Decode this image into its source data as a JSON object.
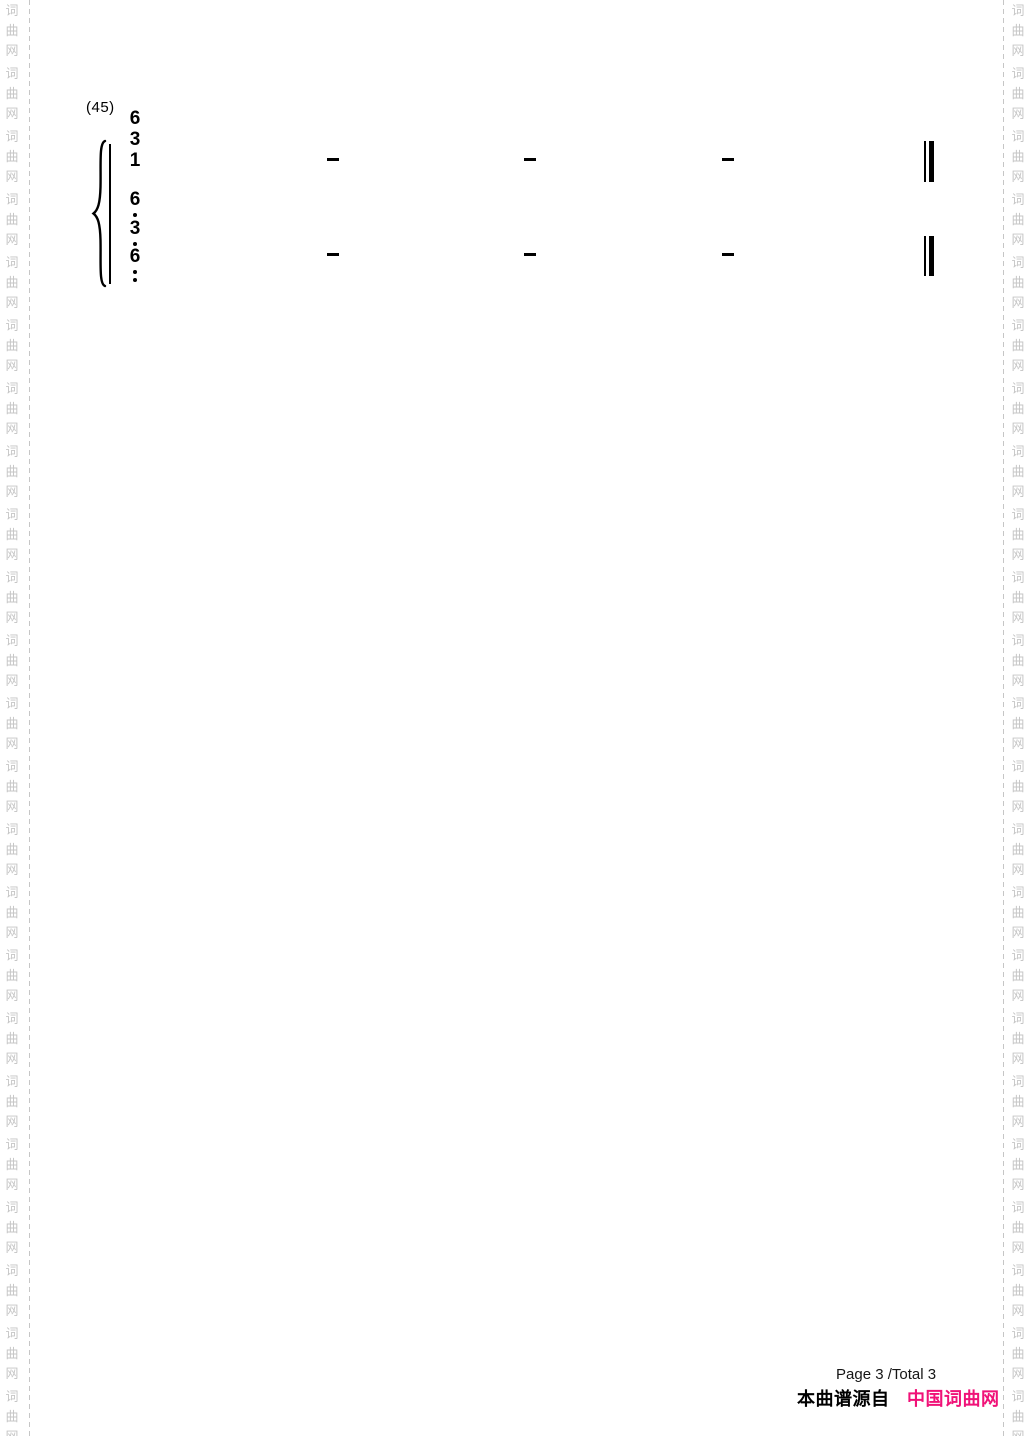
{
  "watermark": {
    "chars": [
      "词",
      "曲",
      "网"
    ],
    "color": "#c6c6c6",
    "group_count": 23
  },
  "score": {
    "measure_number": "(45)",
    "upper_chord_digits": [
      "6",
      "3",
      "1"
    ],
    "lower_chord": [
      {
        "digit": "6",
        "dots_below": 1
      },
      {
        "digit": "3",
        "dots_below": 1
      },
      {
        "digit": "6",
        "dots_below": 2
      }
    ],
    "upper_sustain_dashes": 3,
    "lower_sustain_dashes": 3,
    "final_barline": "thin-thick double bar"
  },
  "footer": {
    "page_info": "Page 3 /Total 3",
    "source_prefix": "本曲谱源自",
    "source_name": "中国词曲网",
    "source_color": "#f01278"
  }
}
